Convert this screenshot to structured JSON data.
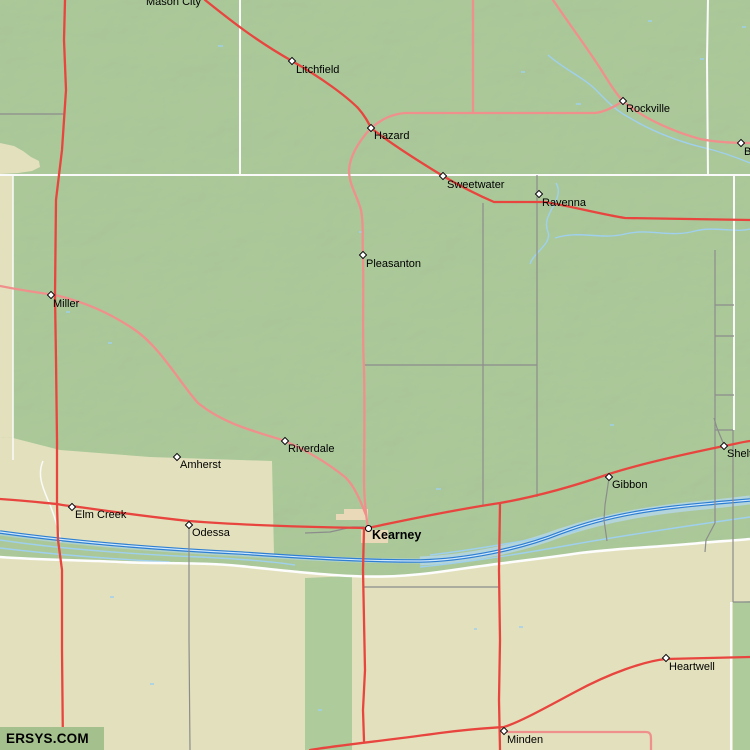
{
  "map": {
    "watermark": "ERSYS.COM"
  },
  "colors": {
    "terrain_green": "#aecb9c",
    "terrain_tan": "#e3e1bd",
    "road_primary_red": "#e8453f",
    "road_secondary_pink": "#f0908c",
    "road_minor_gray": "#8c8c8c",
    "boundary_white": "#fafafa",
    "river_blue": "#2e7ed2",
    "stream_light_blue": "#9fd0ee",
    "urban_tan": "#ead9b8",
    "watermark_bg": "#a4c08d"
  },
  "towns": [
    {
      "name": "Mason City",
      "marker": "none",
      "mx": 210,
      "my": -6,
      "lx": 146,
      "ly": -4
    },
    {
      "name": "Litchfield",
      "marker": "diamond",
      "mx": 292,
      "my": 61,
      "lx": 296,
      "ly": 64
    },
    {
      "name": "Hazard",
      "marker": "diamond",
      "mx": 371,
      "my": 128,
      "lx": 374,
      "ly": 130
    },
    {
      "name": "Rockville",
      "marker": "diamond",
      "mx": 623,
      "my": 101,
      "lx": 626,
      "ly": 103
    },
    {
      "name": "B",
      "marker": "diamond",
      "mx": 741,
      "my": 143,
      "lx": 744,
      "ly": 146
    },
    {
      "name": "Sweetwater",
      "marker": "diamond",
      "mx": 443,
      "my": 176,
      "lx": 447,
      "ly": 179
    },
    {
      "name": "Ravenna",
      "marker": "diamond",
      "mx": 539,
      "my": 194,
      "lx": 542,
      "ly": 197
    },
    {
      "name": "Pleasanton",
      "marker": "diamond",
      "mx": 363,
      "my": 255,
      "lx": 366,
      "ly": 258
    },
    {
      "name": "Miller",
      "marker": "diamond",
      "mx": 51,
      "my": 295,
      "lx": 53,
      "ly": 298
    },
    {
      "name": "Riverdale",
      "marker": "diamond",
      "mx": 285,
      "my": 441,
      "lx": 288,
      "ly": 443
    },
    {
      "name": "Amherst",
      "marker": "diamond",
      "mx": 177,
      "my": 457,
      "lx": 180,
      "ly": 459
    },
    {
      "name": "Elm Creek",
      "marker": "diamond",
      "mx": 72,
      "my": 507,
      "lx": 75,
      "ly": 509
    },
    {
      "name": "Odessa",
      "marker": "diamond",
      "mx": 189,
      "my": 525,
      "lx": 192,
      "ly": 527
    },
    {
      "name": "Kearney",
      "marker": "circle",
      "bold": true,
      "mx": 368,
      "my": 528,
      "lx": 372,
      "ly": 529
    },
    {
      "name": "Gibbon",
      "marker": "diamond",
      "mx": 609,
      "my": 477,
      "lx": 612,
      "ly": 479
    },
    {
      "name": "Shelton",
      "marker": "diamond",
      "mx": 724,
      "my": 446,
      "lx": 727,
      "ly": 448
    },
    {
      "name": "Heartwell",
      "marker": "diamond",
      "mx": 666,
      "my": 658,
      "lx": 669,
      "ly": 661
    },
    {
      "name": "Minden",
      "marker": "diamond",
      "mx": 504,
      "my": 731,
      "lx": 507,
      "ly": 734
    }
  ]
}
